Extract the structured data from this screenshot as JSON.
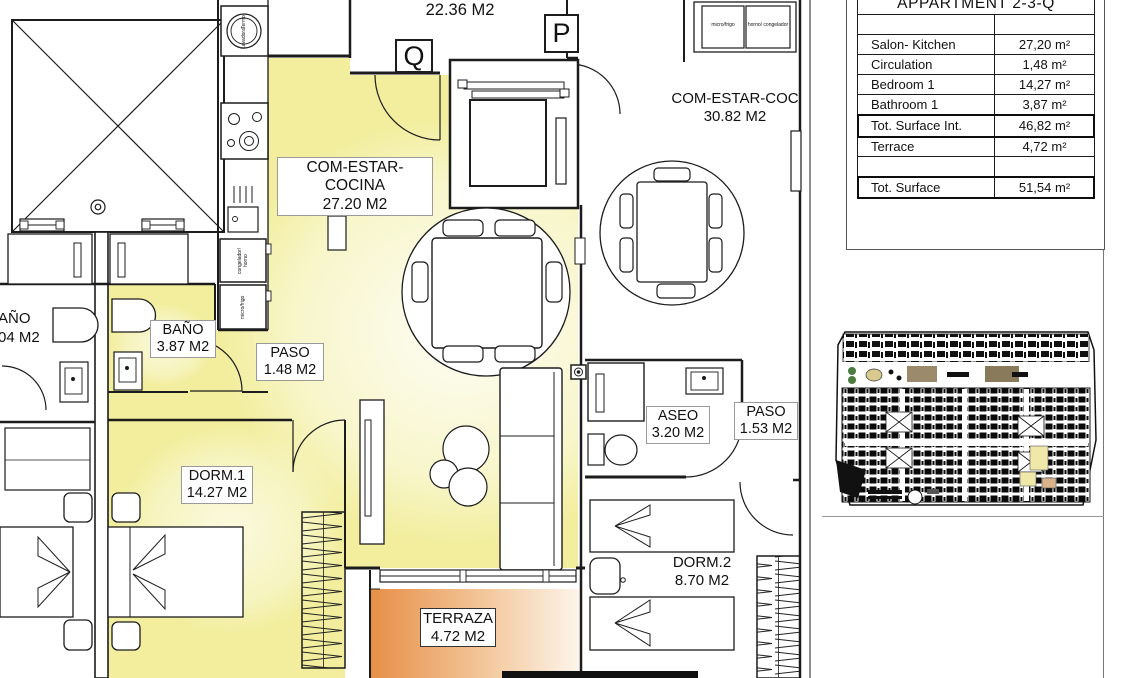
{
  "panel": {
    "title": "APPARTMENT 2-3-Q",
    "unit_rows": [
      {
        "label": "Salon- Kitchen",
        "value": "27,20 m²"
      },
      {
        "label": "Circulation",
        "value": "1,48 m²"
      },
      {
        "label": "Bedroom 1",
        "value": "14,27 m²"
      },
      {
        "label": "Bathroom 1",
        "value": "3,87 m²"
      }
    ],
    "total_int": {
      "label": "Tot. Surface Int.",
      "value": "46,82 m²"
    },
    "terrace_row": {
      "label": "Terrace",
      "value": "4,72 m²"
    },
    "total": {
      "label": "Tot. Surface",
      "value": "51,54 m²"
    }
  },
  "plan": {
    "unit_letter_q": "Q",
    "unit_letter_p": "P",
    "upper_area": "22.36 M2",
    "rooms": {
      "salon": {
        "name": "COM-ESTAR-COCINA",
        "area": "27.20 M2"
      },
      "bano": {
        "name": "BAÑO",
        "area": "3.87 M2"
      },
      "paso": {
        "name": "PASO",
        "area": "1.48 M2"
      },
      "dorm1": {
        "name": "DORM.1",
        "area": "14.27 M2"
      },
      "terraza": {
        "name": "TERRAZA",
        "area": "4.72 M2"
      },
      "salon_p": {
        "name": "COM-ESTAR-COC",
        "area": "30.82 M2"
      },
      "aseo": {
        "name": "ASEO",
        "area": "3.20 M2"
      },
      "paso_p": {
        "name": "PASO",
        "area": "1.53 M2"
      },
      "dorm2": {
        "name": "DORM.2",
        "area": "8.70 M2"
      },
      "bano_neighbor": {
        "name": "AÑO",
        "area": "04 M2"
      }
    },
    "appliances": {
      "washer_line1": "Lavadora",
      "washer_line2": "Termo",
      "freezer_oven": "congelador/ horno",
      "micro_fridge": "micro/frigo",
      "micro_fridge_p": "micro/frigo",
      "oven_freezer_p": "horno/ congelador"
    }
  },
  "colors": {
    "room_fill": "#f2ee9d",
    "terrace_fill": "#e78f47",
    "line": "#1c1c1c"
  }
}
